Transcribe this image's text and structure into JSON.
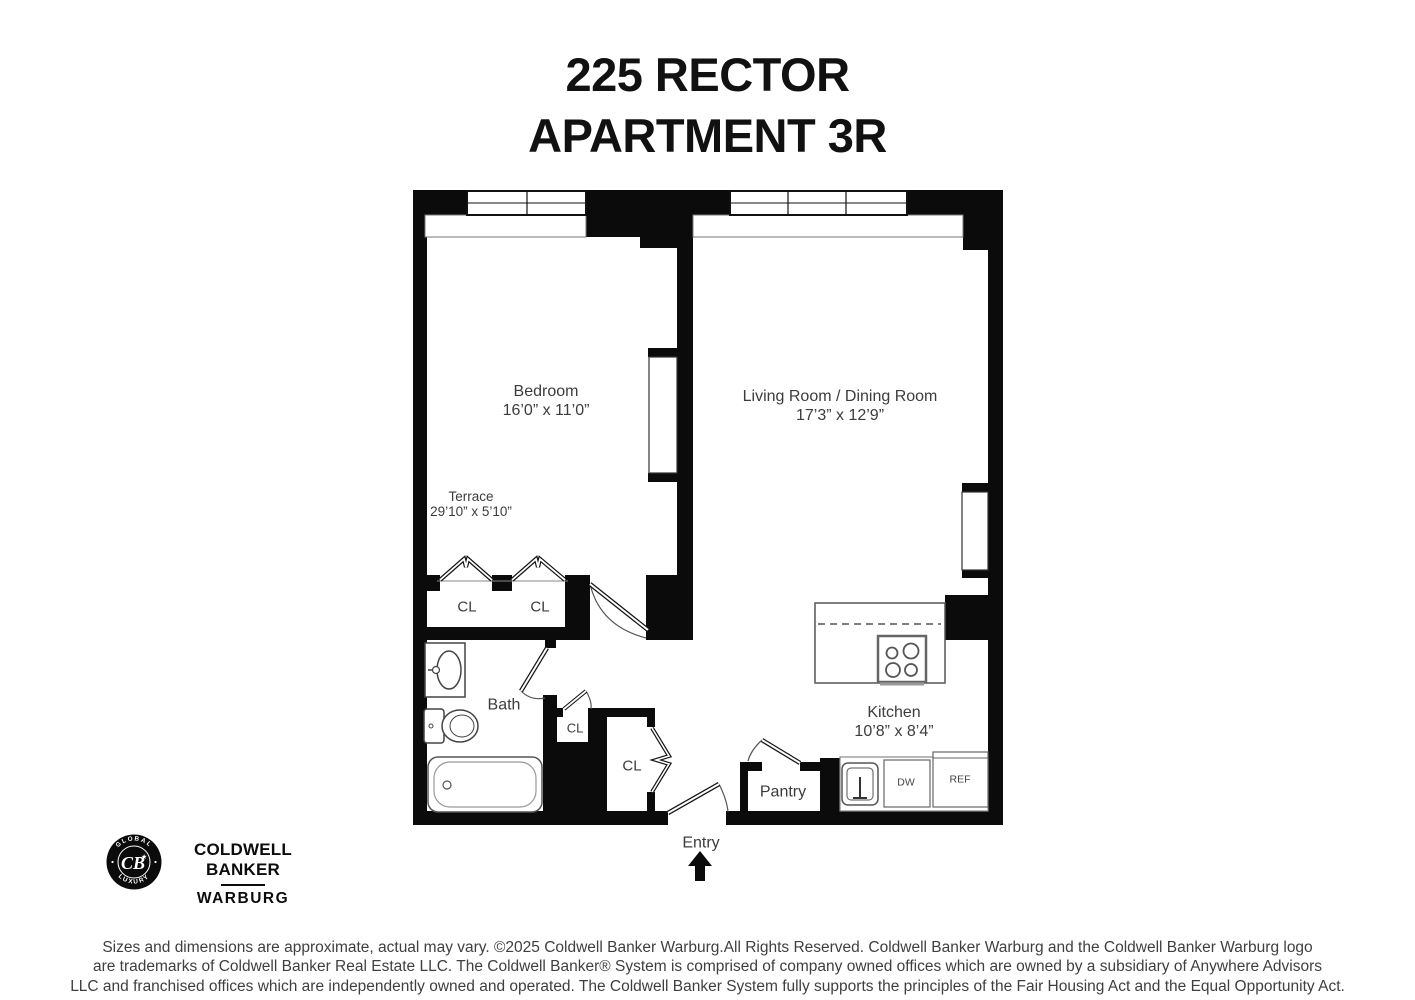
{
  "page": {
    "title_line1": "225 RECTOR",
    "title_line2": "APARTMENT 3R"
  },
  "plan": {
    "bedroom_name": "Bedroom",
    "bedroom_dims": "16’0” x 11’0”",
    "living_name": "Living Room / Dining Room",
    "living_dims": "17’3” x 12’9”",
    "terrace_name": "Terrace",
    "terrace_dims": "29’10” x 5’10”",
    "bath_name": "Bath",
    "kitchen_name": "Kitchen",
    "kitchen_dims": "10’8” x 8’4”",
    "pantry_name": "Pantry",
    "entry_name": "Entry",
    "closet_bedroom_1": "CL",
    "closet_bedroom_2": "CL",
    "closet_hall_small": "CL",
    "closet_hall_large": "CL",
    "dishwasher": "DW",
    "refrigerator": "REF"
  },
  "branding": {
    "seal_top": "GLOBAL",
    "seal_bottom": "LUXURY",
    "seal_monogram": "CB",
    "name_line1": "COLDWELL BANKER",
    "name_line2": "WARBURG"
  },
  "disclaimer": {
    "line1": "Sizes and dimensions are approximate, actual may vary. ©2025 Coldwell Banker Warburg.All Rights Reserved. Coldwell Banker Warburg and the Coldwell Banker Warburg logo",
    "line2": "are trademarks of Coldwell Banker Real Estate LLC. The Coldwell Banker® System is comprised of company owned offices which are owned by a subsidiary of Anywhere Advisors",
    "line3": "LLC and franchised offices which are independently owned and operated. The Coldwell Banker System fully supports the principles of the Fair Housing Act and the Equal Opportunity Act."
  },
  "colors": {
    "wall": "#0b0b0b",
    "label": "#3c3c3c",
    "background": "#ffffff"
  }
}
